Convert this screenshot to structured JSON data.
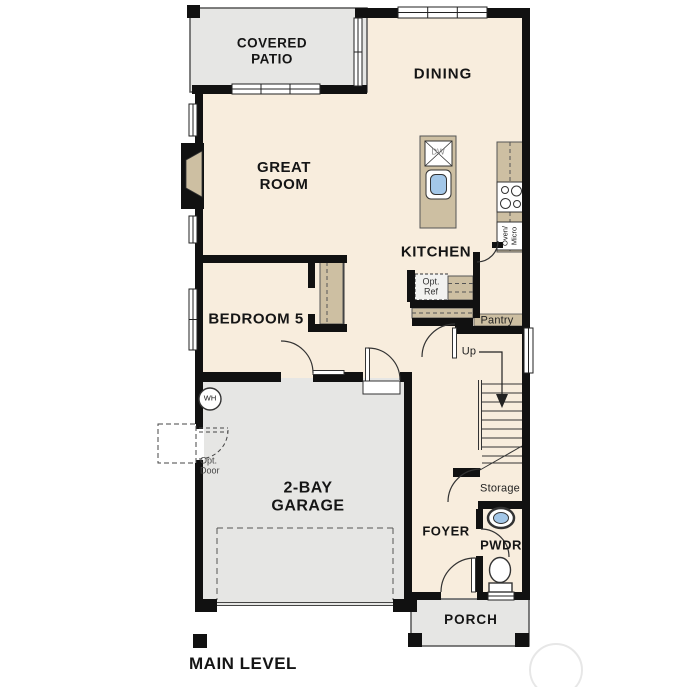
{
  "plan": {
    "title": "MAIN LEVEL",
    "rooms": {
      "covered_patio": "COVERED PATIO",
      "dining": "DINING",
      "great_room": "GREAT ROOM",
      "kitchen": "KITCHEN",
      "bedroom5": "BEDROOM 5",
      "garage": "2-BAY GARAGE",
      "foyer": "FOYER",
      "pwdr": "PWDR",
      "porch": "PORCH"
    },
    "features": {
      "pantry": "Pantry",
      "storage": "Storage",
      "up": "Up",
      "dw": "DW",
      "oven_micro_line1": "Oven/",
      "oven_micro_line2": "Micro",
      "opt_ref": "Opt. Ref",
      "opt_door": "Opt. Door",
      "wh": "WH"
    },
    "colors": {
      "floor": "#f8eddd",
      "outdoor": "#e6e6e4",
      "cabinet": "#cdbfa2",
      "wall": "#111111",
      "sink_blue": "#a3c7e8"
    }
  }
}
